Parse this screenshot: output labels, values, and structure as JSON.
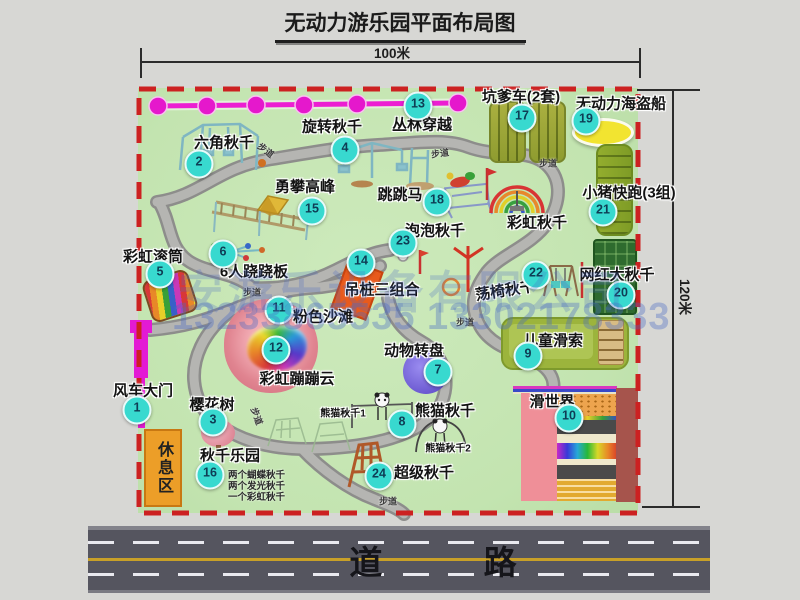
{
  "title": "无动力游乐园平面布局图",
  "dimensions": {
    "width": "100米",
    "height": "120米"
  },
  "road_label": "道 路",
  "path_label": "步道",
  "watermark": {
    "company": "安游乐设备有限公司",
    "phones": "13233865535 13302178333"
  },
  "colors": {
    "map_bg": "#c6e6b4",
    "border_red": "#cc2121",
    "badge": "#38d9cf",
    "gate_magenta": "#e31ad4",
    "zipline": "#ec1ed2"
  },
  "items": {
    "i1": {
      "num": "1",
      "label": "风车大门"
    },
    "i2": {
      "num": "2",
      "label": "六角秋千"
    },
    "i3": {
      "num": "3",
      "label": "樱花树"
    },
    "i4": {
      "num": "4",
      "label": "旋转秋千"
    },
    "i5": {
      "num": "5",
      "label": "彩虹滚筒"
    },
    "i6": {
      "num": "6",
      "label": "6人跷跷板"
    },
    "i7": {
      "num": "7",
      "label": "动物转盘"
    },
    "i8": {
      "num": "8",
      "label": "熊猫秋千",
      "sub1": "熊猫秋千1",
      "sub2": "熊猫秋千2"
    },
    "i9": {
      "num": "9",
      "label": "儿童滑索"
    },
    "i10": {
      "num": "10",
      "label": "滑世界"
    },
    "i11": {
      "num": "11",
      "label": "粉色沙滩"
    },
    "i12": {
      "num": "12",
      "label": "彩虹蹦蹦云"
    },
    "i13": {
      "num": "13",
      "label": "丛林穿越"
    },
    "i14": {
      "num": "14",
      "label": "吊桩三组合"
    },
    "i15": {
      "num": "15",
      "label": "勇攀高峰"
    },
    "i16": {
      "num": "16",
      "label": "秋千乐园",
      "notes": [
        "两个蝴蝶秋千",
        "两个发光秋千",
        "一个彩虹秋千"
      ]
    },
    "i17": {
      "num": "17",
      "label": "坑爹车(2套)"
    },
    "i18": {
      "num": "18",
      "label": "跳跳马"
    },
    "i19": {
      "num": "19",
      "label": "无动力海盗船"
    },
    "i20": {
      "num": "20",
      "label": "网红大秋千"
    },
    "i21": {
      "num": "21",
      "label": "小猪快跑(3组)"
    },
    "i22": {
      "num": "22",
      "label": "荡椅秋千"
    },
    "i23": {
      "num": "23",
      "label": "泡泡秋千"
    },
    "i24": {
      "num": "24",
      "label": "超级秋千"
    },
    "rainbow": {
      "label": "彩虹秋千"
    },
    "rest": {
      "label": "休息区"
    }
  }
}
